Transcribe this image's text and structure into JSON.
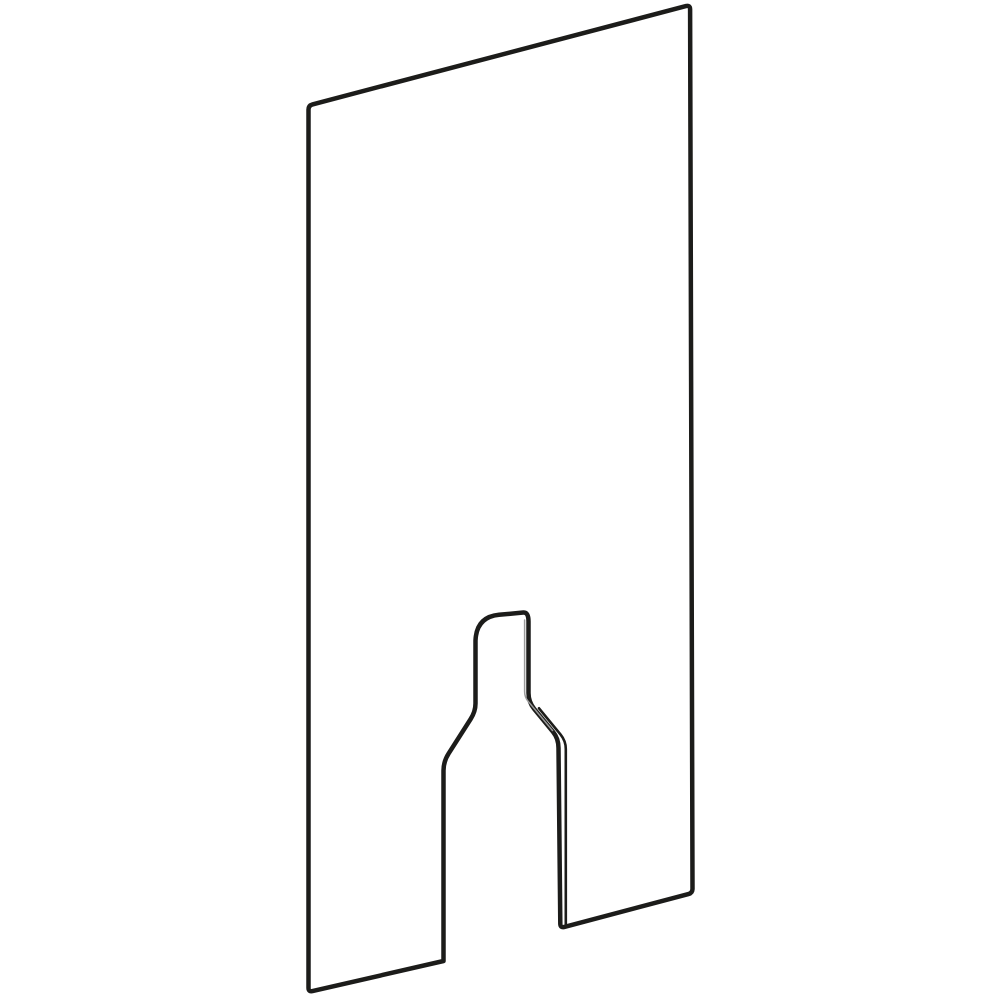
{
  "page": {
    "background_color": "#ffffff"
  },
  "figure": {
    "name": "panel-with-bottle-shaped-cutout",
    "description": "Black-outline technical illustration of a tall rectangular panel drawn in slight perspective (top and bottom edges rising to the right), with a bottle-shaped cutout opening through the bottom edge",
    "outline_color": "#1c1c1a",
    "inner_edge_color": "#1c1c1a",
    "neck_edge_color": "#9a9a9a",
    "outline_stroke_width": "4.5",
    "inner_edge_stroke_width": "2.6",
    "neck_edge_stroke_width": "1.5",
    "canvas": {
      "width": "1000",
      "height": "1000",
      "viewbox": "0 0 1000 1000"
    }
  },
  "paths": {
    "panel_outline": "M 443.5 961 L 312.5 991.1 Q 308.5 992 308.5 987.9 L 308.5 109.6 Q 308.5 105.5 312.5 104.4 L 685.9 6.1 Q 690 5 690.1 9.2 L 692.5 888.7 Q 692.5 893 688.4 894.1 L 564.4 926.9 Q 560.3 928 560.3 923.8 L 558.5 748 Q 558.5 738.5 553 731.8 L 534.2 708.9 Q 528.5 702 528.5 693 L 528.5 621.5 Q 528.5 612 523.3 612.5 L 499 614.8 Q 476.5 617 475.5 640.5 L 475.5 703.5 Q 475.5 711.5 470.6 719.1 L 448.6 753.6 Q 443.5 761.6 443.5 770.5 Z",
    "cutout_inner_edge": "M 565.8 924.5 L 565.8 749 Q 565.8 741 560.6 734.6 L 539 708.3",
    "neck_inner_edge": "M 524.6 620 L 524.6 691.5 Q 524.6 697 528 701.2 L 552.5 730.5"
  }
}
